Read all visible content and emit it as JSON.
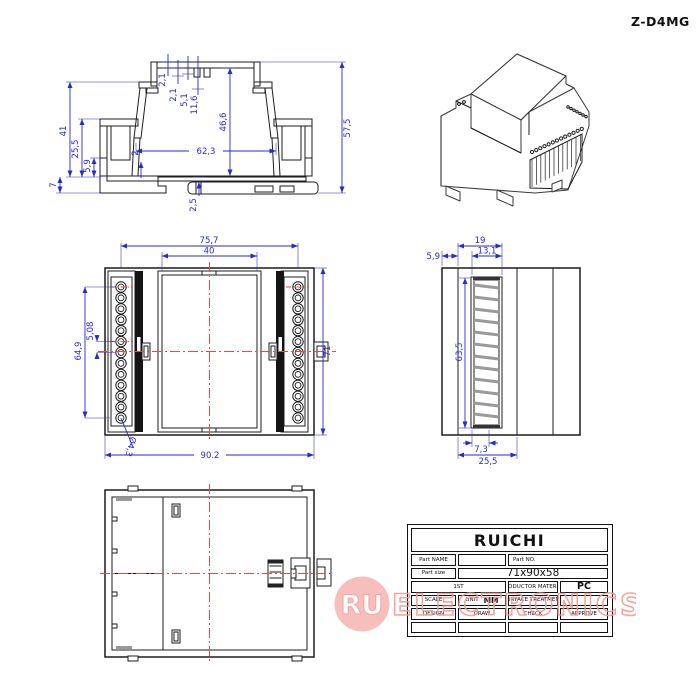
{
  "header": {
    "model": "Z-D4MG"
  },
  "dims": {
    "section": {
      "t_2_1a": "2,1",
      "t_2_1b": "2,1",
      "t_5_1": "5,1",
      "t_11_6": "11,6",
      "cavity_h": "46,6",
      "cavity_w": "62,3",
      "wall_2": "2",
      "base_2_5": "2,5",
      "left_41": "41",
      "left_25_5": "25,5",
      "left_5_9": "5,9",
      "left_7": "7",
      "right_57_5": "57,5"
    },
    "front": {
      "top_75_7": "75,7",
      "top_40": "40",
      "left_64_9": "64,9",
      "left_5_08": "5,08",
      "hole_dia": "Ø4,3",
      "bottom_90_2": "90.2",
      "right_71": "71"
    },
    "side": {
      "top_19": "19",
      "top_5_9": "5,9",
      "top_13_1": "13,1",
      "left_63_5": "63,5",
      "bottom_7_3": "7,3",
      "bottom_25_5": "25,5"
    }
  },
  "title_block": {
    "brand": "RUICHI",
    "part_name_label": "Part NAME",
    "part_no_label": "Part NO.",
    "part_size_label": "Part size",
    "part_size_value": "71x90x58",
    "first_label": "1ST",
    "productor_material_label": "PRODUCTOR MATERIAL",
    "material_value": "PC",
    "scale_label": "SCALE",
    "unit_label": "UNIT",
    "unit_value": "MM",
    "surface_label": "SURFACE TREATMENT",
    "design_label": "DESIGN",
    "draw_label": "DRAW",
    "check_label": "CHECK",
    "approve_label": "APPROVE"
  },
  "watermark": {
    "badge": "RU",
    "brand": "ELECTRONICS"
  },
  "colors": {
    "dimension": "#2a2ac8",
    "centerline": "#e64a45",
    "hatch_green": "#17c427",
    "hatch_magenta": "#ee22ee",
    "hatch_yellow": "#e8dc00",
    "hatch_cyan": "#00d2d2",
    "watermark": "#f29b94"
  }
}
